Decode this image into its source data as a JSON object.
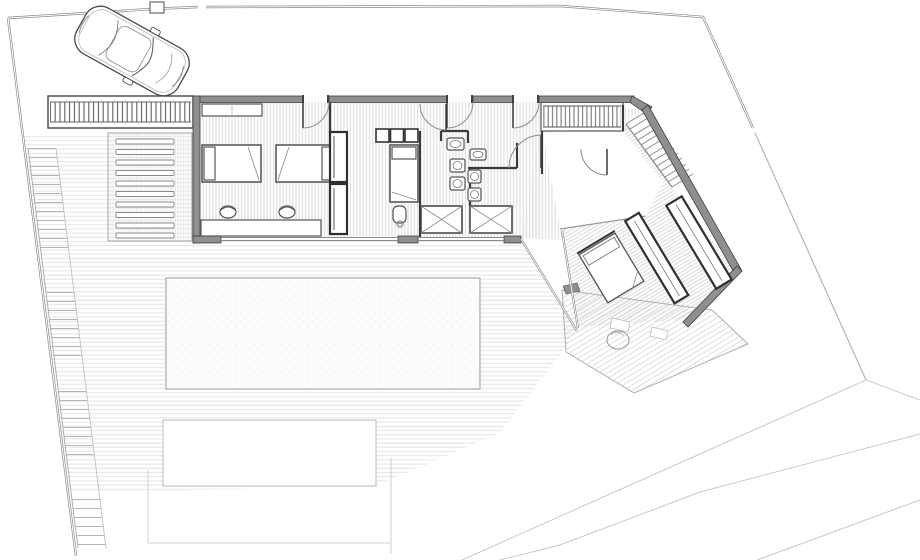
{
  "document": {
    "title": "Residential villa – ground floor site plan",
    "drawing_type": "architectural floor plan",
    "style": "monochrome CAD line drawing, no text labels"
  },
  "colors": {
    "paper": "#ffffff",
    "wall_fill": "#8f8f8f",
    "wall_edge": "#3f3f3f",
    "partition": "#3a3a3a",
    "furniture_line": "#555555",
    "floor_hatch": "#d6d6d6",
    "deck_line": "#e0e0e0",
    "boundary": "#8a8a8a",
    "contour": "#c9c9c9",
    "stair_line": "#b5b5b5"
  },
  "site": {
    "features": [
      {
        "name": "parked-car",
        "label": "car parked in driveway"
      },
      {
        "name": "driveway",
        "label": "entry driveway"
      },
      {
        "name": "pergola-slats",
        "label": "slatted pergola band"
      },
      {
        "name": "louvered-steps",
        "label": "louvered garden steps"
      },
      {
        "name": "side-ramp",
        "label": "stepped side ramp along boundary"
      },
      {
        "name": "timber-deck",
        "label": "decked terrace"
      },
      {
        "name": "swimming-pool",
        "label": "swimming pool"
      },
      {
        "name": "lower-patio",
        "label": "lower patio"
      },
      {
        "name": "boundary-fence",
        "label": "site boundary wall and fence"
      },
      {
        "name": "terrain-contours",
        "label": "terrain contour lines"
      }
    ]
  },
  "building": {
    "rooms": [
      {
        "name": "bedroom-1",
        "furniture": [
          "single-bed",
          "single-bed",
          "desk",
          "stool",
          "stool",
          "wall-shelf",
          "wardrobe",
          "wardrobe"
        ]
      },
      {
        "name": "bedroom-2",
        "furniture": [
          "single-bed",
          "closet-cubbies",
          "chair"
        ]
      },
      {
        "name": "bathroom-1",
        "furniture": [
          "washbasin",
          "wc",
          "bidet",
          "shower"
        ]
      },
      {
        "name": "bathroom-2",
        "furniture": [
          "washbasin",
          "wc",
          "bidet",
          "shower"
        ]
      },
      {
        "name": "entry-hall",
        "furniture": []
      },
      {
        "name": "master-bedroom",
        "furniture": [
          "double-bed",
          "wardrobe",
          "wardrobe"
        ]
      },
      {
        "name": "master-terrace",
        "furniture": [
          "planter"
        ]
      }
    ],
    "circulation": [
      "entry-stair",
      "slat-bridge",
      "side-ramp"
    ],
    "door_count": 6,
    "shower_count": 2,
    "bed_count": 4
  }
}
